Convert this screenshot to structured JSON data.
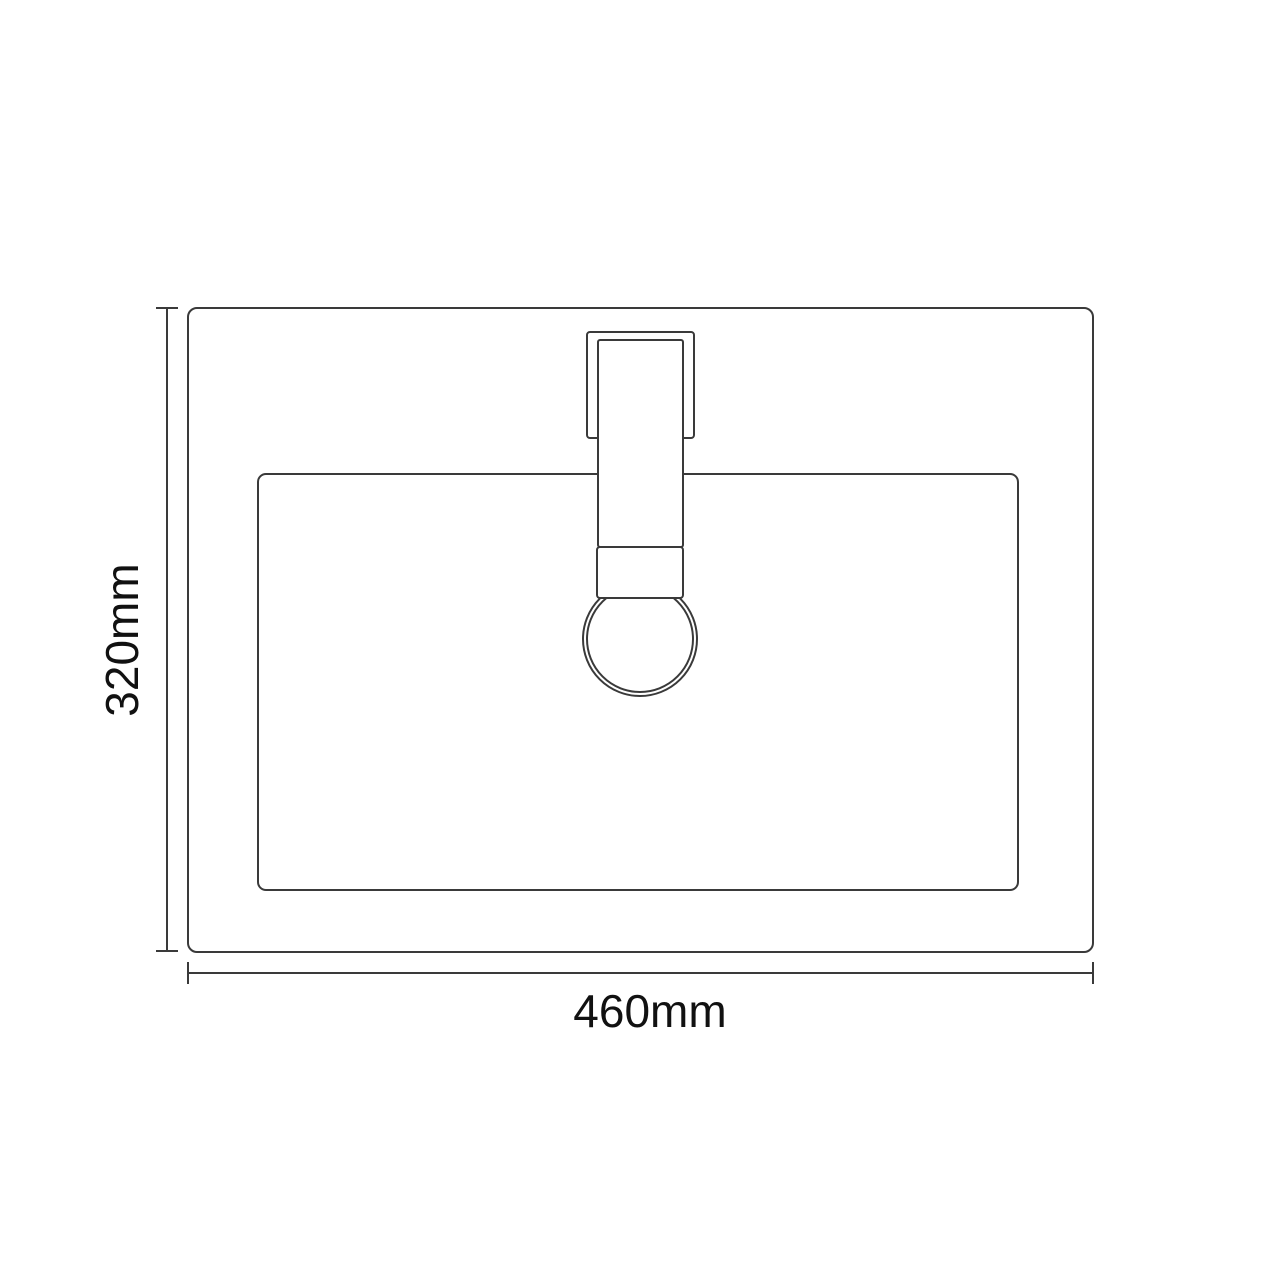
{
  "diagram": {
    "description": "Top-view technical line drawing of a rectangular countertop basin sink with a single centered square tap and round tap hole",
    "dimension_labels": {
      "height": "320mm",
      "width": "460mm"
    },
    "dimensions_mm": {
      "width": 460,
      "height": 320
    }
  },
  "colors": {
    "background": "#ffffff",
    "line": "#3a3a3a",
    "text": "#111111"
  }
}
